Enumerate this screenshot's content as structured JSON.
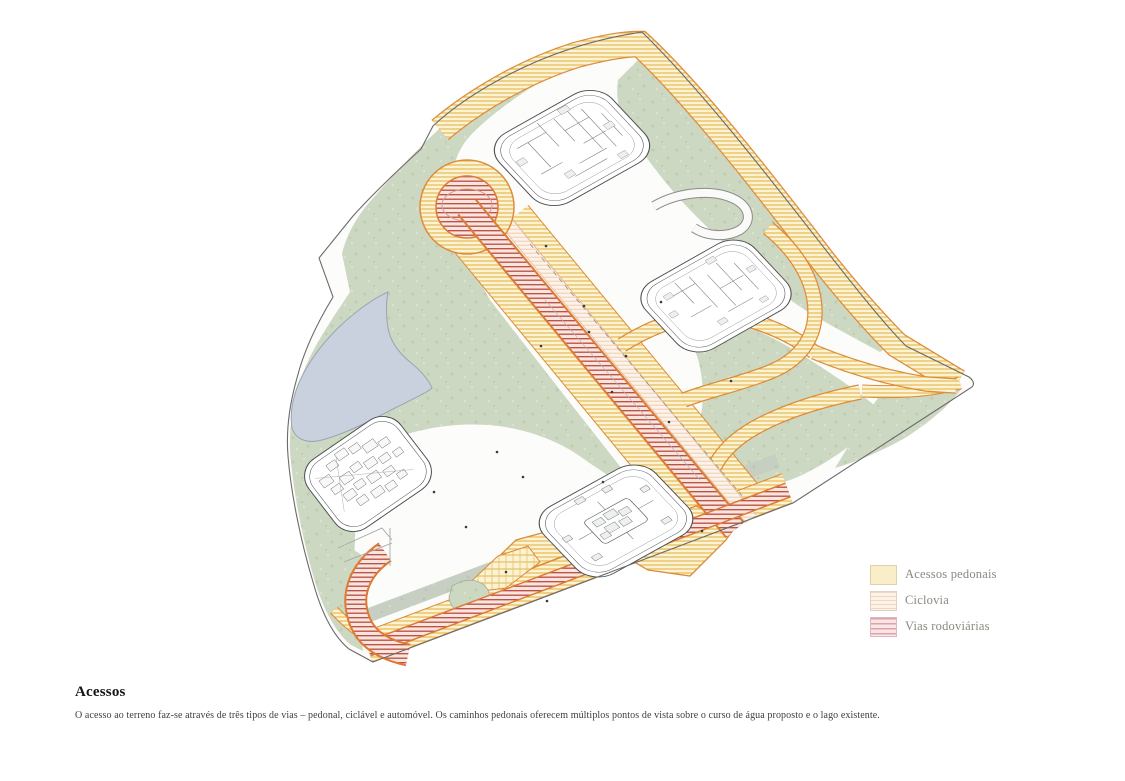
{
  "title_block": {
    "title": "Acessos",
    "description": "O acesso ao terreno faz-se através de três tipos de vias – pedonal, ciclável e automóvel. Os caminhos pedonais oferecem múltiplos pontos de vista sobre o curso de água proposto e o lago existente."
  },
  "legend": {
    "items": [
      {
        "id": "pedestrian",
        "label": "Acessos pedonais"
      },
      {
        "id": "cycleway",
        "label": "Ciclovia"
      },
      {
        "id": "roads",
        "label": "Vias rodoviárias"
      }
    ]
  },
  "illustration": {
    "kind": "axonometric-masterplan",
    "buildings_count": 4,
    "features": [
      "pedestrian paths",
      "cycle lane",
      "roads with cul-de-sac",
      "lake",
      "green landscape"
    ],
    "colors": {
      "pedestrian_fill": "#fcf3d2",
      "pedestrian_stripe": "#e2b44c",
      "path_border": "#dd8c3a",
      "road_fill": "#f7e5de",
      "road_stripe": "#bc4a40",
      "cycleway_fill": "#fdf3ea",
      "cycleway_stripe": "#eccdb0",
      "green": "#cdd8c3",
      "green_dark": "#c3cec0",
      "lake": "#c8d1dd",
      "building_line": "#4a4d4f",
      "boundary_line": "#6a6a6a"
    }
  }
}
